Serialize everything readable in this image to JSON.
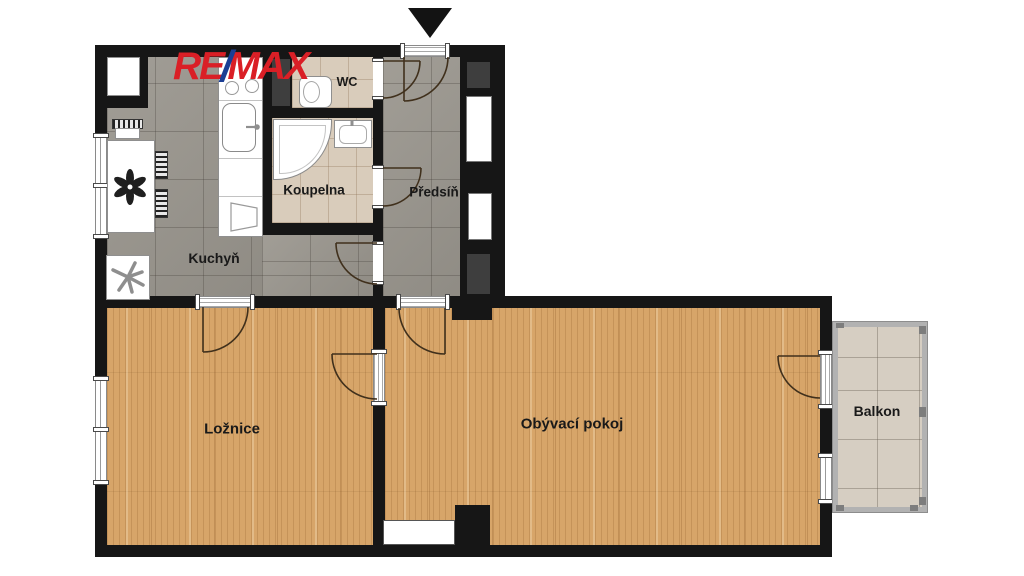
{
  "logo": {
    "re": "RE",
    "slash": "/",
    "max": "MAX"
  },
  "rooms": {
    "kuchyn": {
      "label": "Kuchyň"
    },
    "wc": {
      "label": "WC"
    },
    "koupelna": {
      "label": "Koupelna"
    },
    "predsin": {
      "label": "Předsíň"
    },
    "loznice": {
      "label": "Ložnice"
    },
    "obyvaci_pokoj": {
      "label": "Obývací pokoj"
    },
    "balkon": {
      "label": "Balkon"
    }
  },
  "icons": {
    "entrance_arrow": "triangle-down-entrance-marker",
    "flower": "dining-table-flower-centerpiece",
    "fan": "kitchen-appliance-fan-symbol"
  },
  "colors": {
    "wall": "#161616",
    "wood": "#d7a569",
    "gtile": "#9a968e",
    "btile": "#d9ccbb",
    "bfloor": "#d6cec2",
    "shaft": "#3e3e3e",
    "red": "#da1f26",
    "blue": "#1b3e94",
    "arc": "#40301c"
  }
}
